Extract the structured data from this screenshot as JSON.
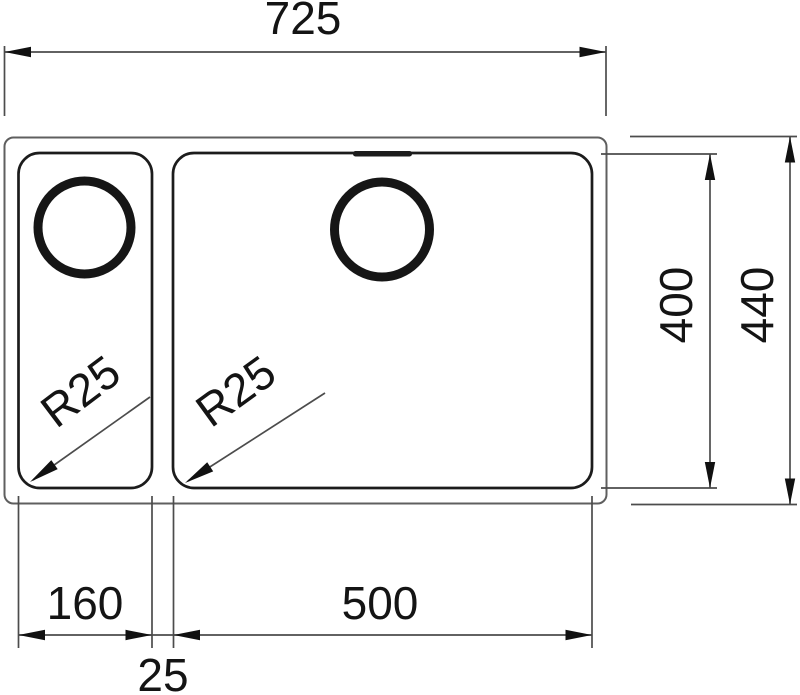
{
  "drawing": {
    "type": "sink-dimension-drawing",
    "labels": {
      "overall_width": "725",
      "overall_depth": "440",
      "bowl_depth": "400",
      "small_bowl_width": "160",
      "large_bowl_width": "500",
      "bowl_gap": "25",
      "small_bowl_corner_radius": "R25",
      "large_bowl_corner_radius": "R25"
    },
    "colors": {
      "background": "#ffffff",
      "thin_line": "#4c4c4c",
      "outer_outline": "#5f5f5f",
      "bowl_outline": "#1c1c1c",
      "text": "#141414"
    }
  }
}
